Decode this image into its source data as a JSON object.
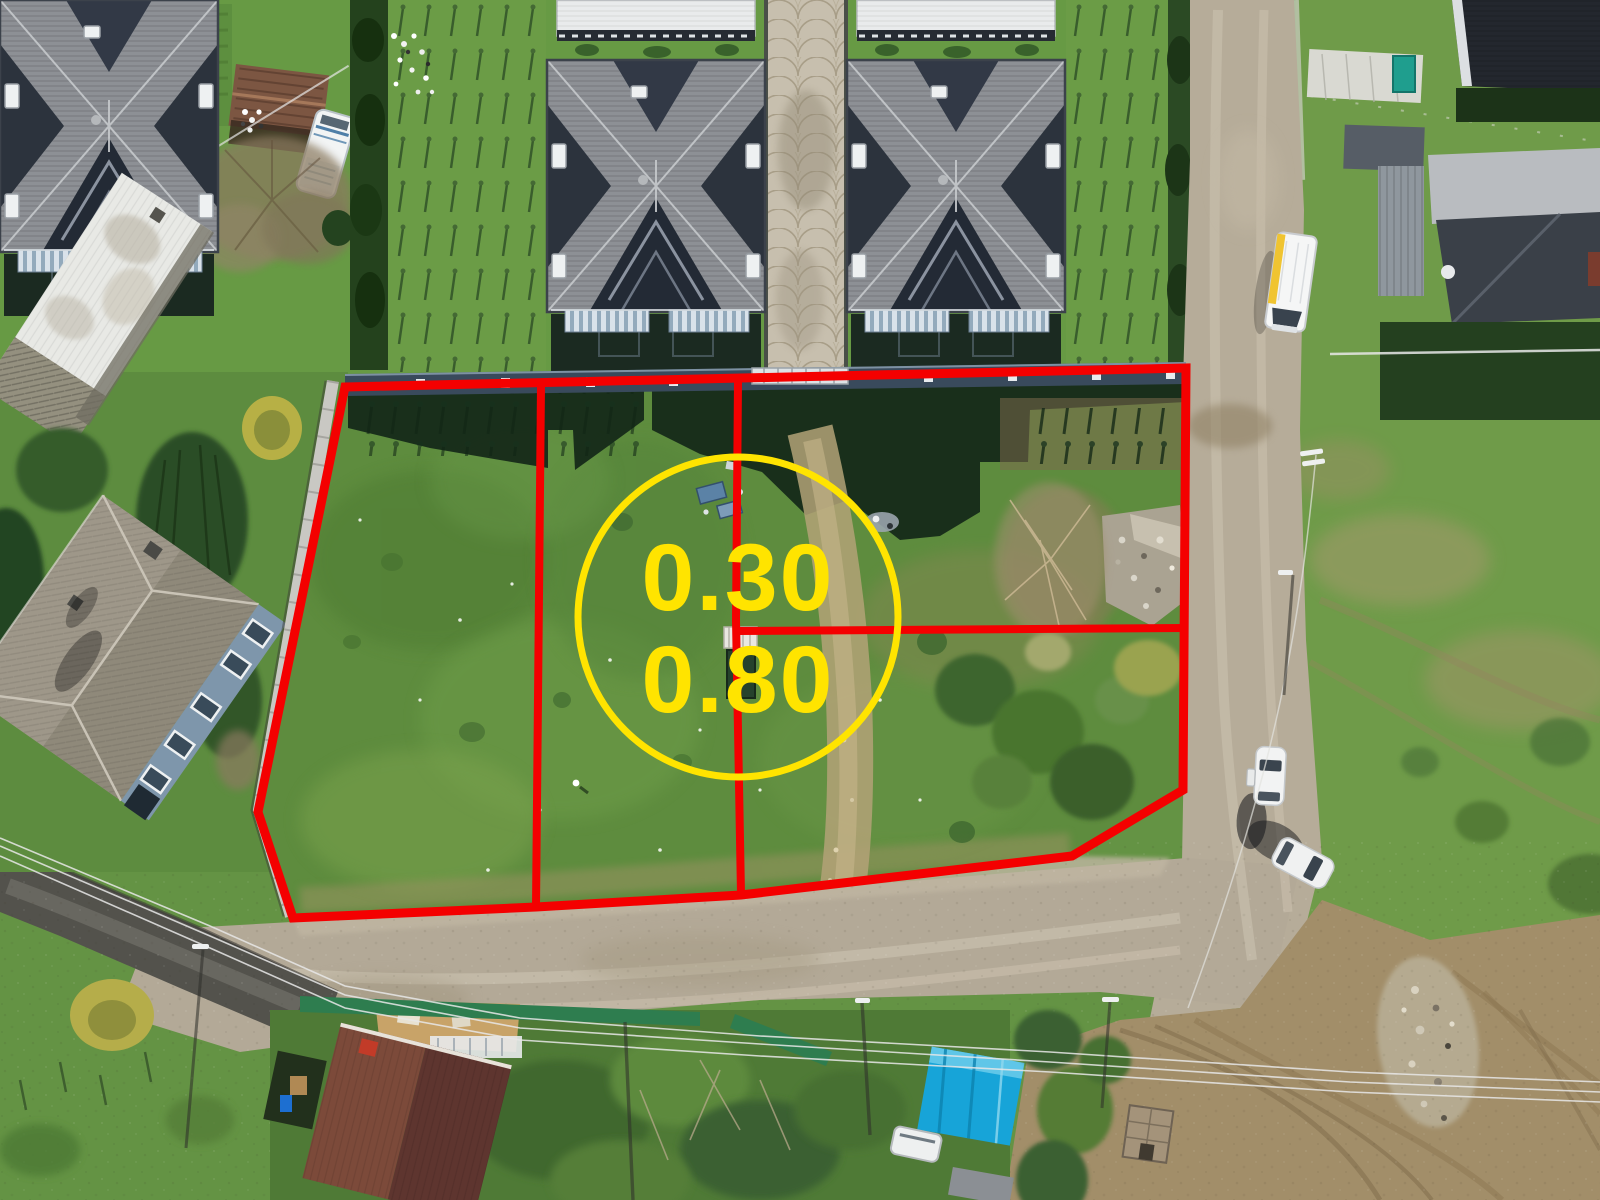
{
  "image": {
    "kind": "aerial-drone-photo",
    "subject": "vacant land parcel for sale outlined in red among village houses, gravel roads and gardens",
    "width_px": 1600,
    "height_px": 1200
  },
  "overlay": {
    "boundary_color": "#f40000",
    "boundary_description": "red parcel outline with two vertical dividers and one horizontal split line",
    "circle": {
      "color": "#ffe400",
      "text_color": "#ffe400",
      "label_top": "0.30",
      "label_bottom": "0.80"
    }
  },
  "scene": {
    "ground_colors": {
      "grass": "#5e8c3f",
      "gravel_road": "#b4aa97",
      "asphalt_road": "#53524c",
      "dirt_field": "#a28e69",
      "parcel_grass": "#5e8c3e"
    },
    "buildings": [
      {
        "name": "twin-house-left",
        "roof_color": "#8d9095"
      },
      {
        "name": "twin-house-right",
        "roof_color": "#8d9095"
      },
      {
        "name": "stone-walkway-between-houses",
        "color": "#c7bfae"
      },
      {
        "name": "hip-roof-house-left",
        "roof_color": "#9e9789",
        "wall_color": "#7e96ab"
      },
      {
        "name": "white-flat-roof-building",
        "roof_color": "#e8e9e5"
      },
      {
        "name": "rusty-shed-top-left",
        "roof_color": "#7c5642"
      },
      {
        "name": "white-caravan",
        "color": "#f2f4f4"
      },
      {
        "name": "red-tile-roof-house-bottom",
        "roof_color": "#6e4038"
      },
      {
        "name": "blue-tarp-structure",
        "color": "#17a4d8"
      },
      {
        "name": "gray-roof-house-top-right",
        "roof_color": "#3a4048"
      },
      {
        "name": "dark-ridged-roof-top-right",
        "roof_color": "#23272e"
      },
      {
        "name": "wooden-hut-bottom-right",
        "color": "#a4937a"
      }
    ],
    "vehicles": [
      {
        "name": "box-van-on-road",
        "color": "#f5f6f6",
        "accent": "#f0c431"
      },
      {
        "name": "white-car-parked",
        "color": "#f2f3f3"
      },
      {
        "name": "white-car-angled",
        "color": "#f0f1f1"
      }
    ],
    "features": [
      "boundary-wall",
      "orchard-sapling-rows",
      "hedge-rows",
      "power-lines-and-poles",
      "rubble-pile",
      "house-shadows",
      "dirt-track-through-parcel"
    ]
  }
}
